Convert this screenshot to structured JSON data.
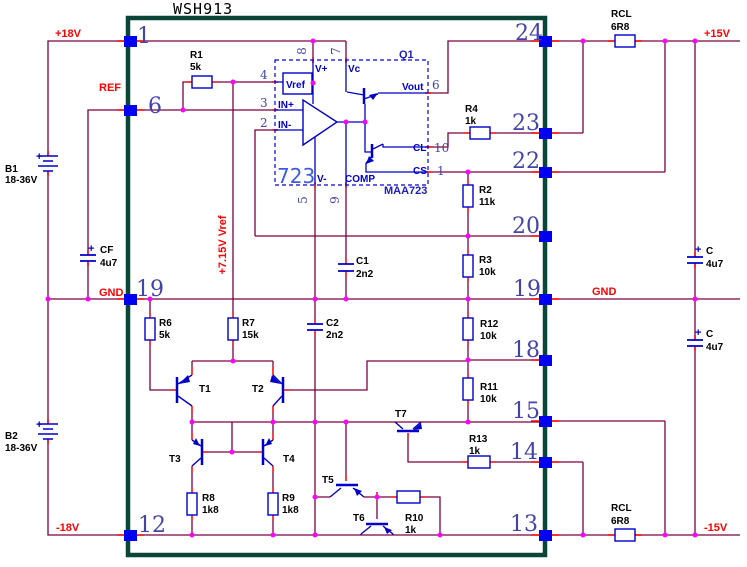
{
  "title": "WSH913",
  "pins": {
    "p1": "1",
    "p6": "6",
    "p19l": "19",
    "p12": "12",
    "p24": "24",
    "p23": "23",
    "p22": "22",
    "p20": "20",
    "p19r": "19",
    "p18": "18",
    "p15": "15",
    "p14": "14",
    "p13": "13"
  },
  "rails": {
    "p18v": "+18V",
    "ref": "REF",
    "gndl": "GND",
    "m18v": "-18V",
    "p15v": "+15V",
    "gndr": "GND",
    "m15v": "-15V",
    "vref715": "+7.15V Vref"
  },
  "components": {
    "b1": "B1",
    "b1_value": "18-36V",
    "b1_plus": "+",
    "b2": "B2",
    "b2_value": "18-36V",
    "b2_plus": "+",
    "cf": "CF",
    "cf_value": "4u7",
    "cf_plus": "+",
    "r1": "R1",
    "r1_value": "5k",
    "rcl_top": "RCL",
    "rcl_top_value": "6R8",
    "rcl_bot": "RCL",
    "rcl_bot_value": "6R8",
    "r2": "R2",
    "r2_value": "11k",
    "r3": "R3",
    "r3_value": "10k",
    "r4": "R4",
    "r4_value": "1k",
    "r6": "R6",
    "r6_value": "5k",
    "r7": "R7",
    "r7_value": "15k",
    "r8": "R8",
    "r8_value": "1k8",
    "r9": "R9",
    "r9_value": "1k8",
    "r10": "R10",
    "r10_value": "1k",
    "r11": "R11",
    "r11_value": "10k",
    "r12": "R12",
    "r12_value": "10k",
    "r13": "R13",
    "r13_value": "1k",
    "c1": "C1",
    "c1_value": "2n2",
    "c2": "C2",
    "c2_value": "2n2",
    "c_top": "C",
    "c_top_value": "4u7",
    "c_top_plus": "+",
    "c_bot": "C",
    "c_bot_value": "4u7",
    "c_bot_plus": "+",
    "t1": "T1",
    "t2": "T2",
    "t3": "T3",
    "t4": "T4",
    "t5": "T5",
    "t6": "T6",
    "t7": "T7"
  },
  "ic723": {
    "name": "723",
    "part": "MAA723",
    "q1": "Q1",
    "vref": "Vref",
    "vplus": "V+",
    "vc": "Vc",
    "inp": "IN+",
    "inn": "IN-",
    "vminus": "V-",
    "comp": "COMP",
    "vout": "Vout",
    "cl": "CL",
    "cs": "CS",
    "pin4": "4",
    "pin3": "3",
    "pin2": "2",
    "pin8": "8",
    "pin7": "7",
    "pin5": "5",
    "pin9": "9",
    "pin6": "6",
    "pin10": "10",
    "pin1": "1"
  },
  "colors": {
    "wire": "#7D0042",
    "stub": "#FF0000",
    "node": "#FF00FF",
    "component_blue": "#0000CC",
    "pin_square": "#0000F0",
    "pin_text": "#4343AC",
    "border_green": "#0A4638",
    "label_red": "#FF0000",
    "label_black": "#000000"
  }
}
